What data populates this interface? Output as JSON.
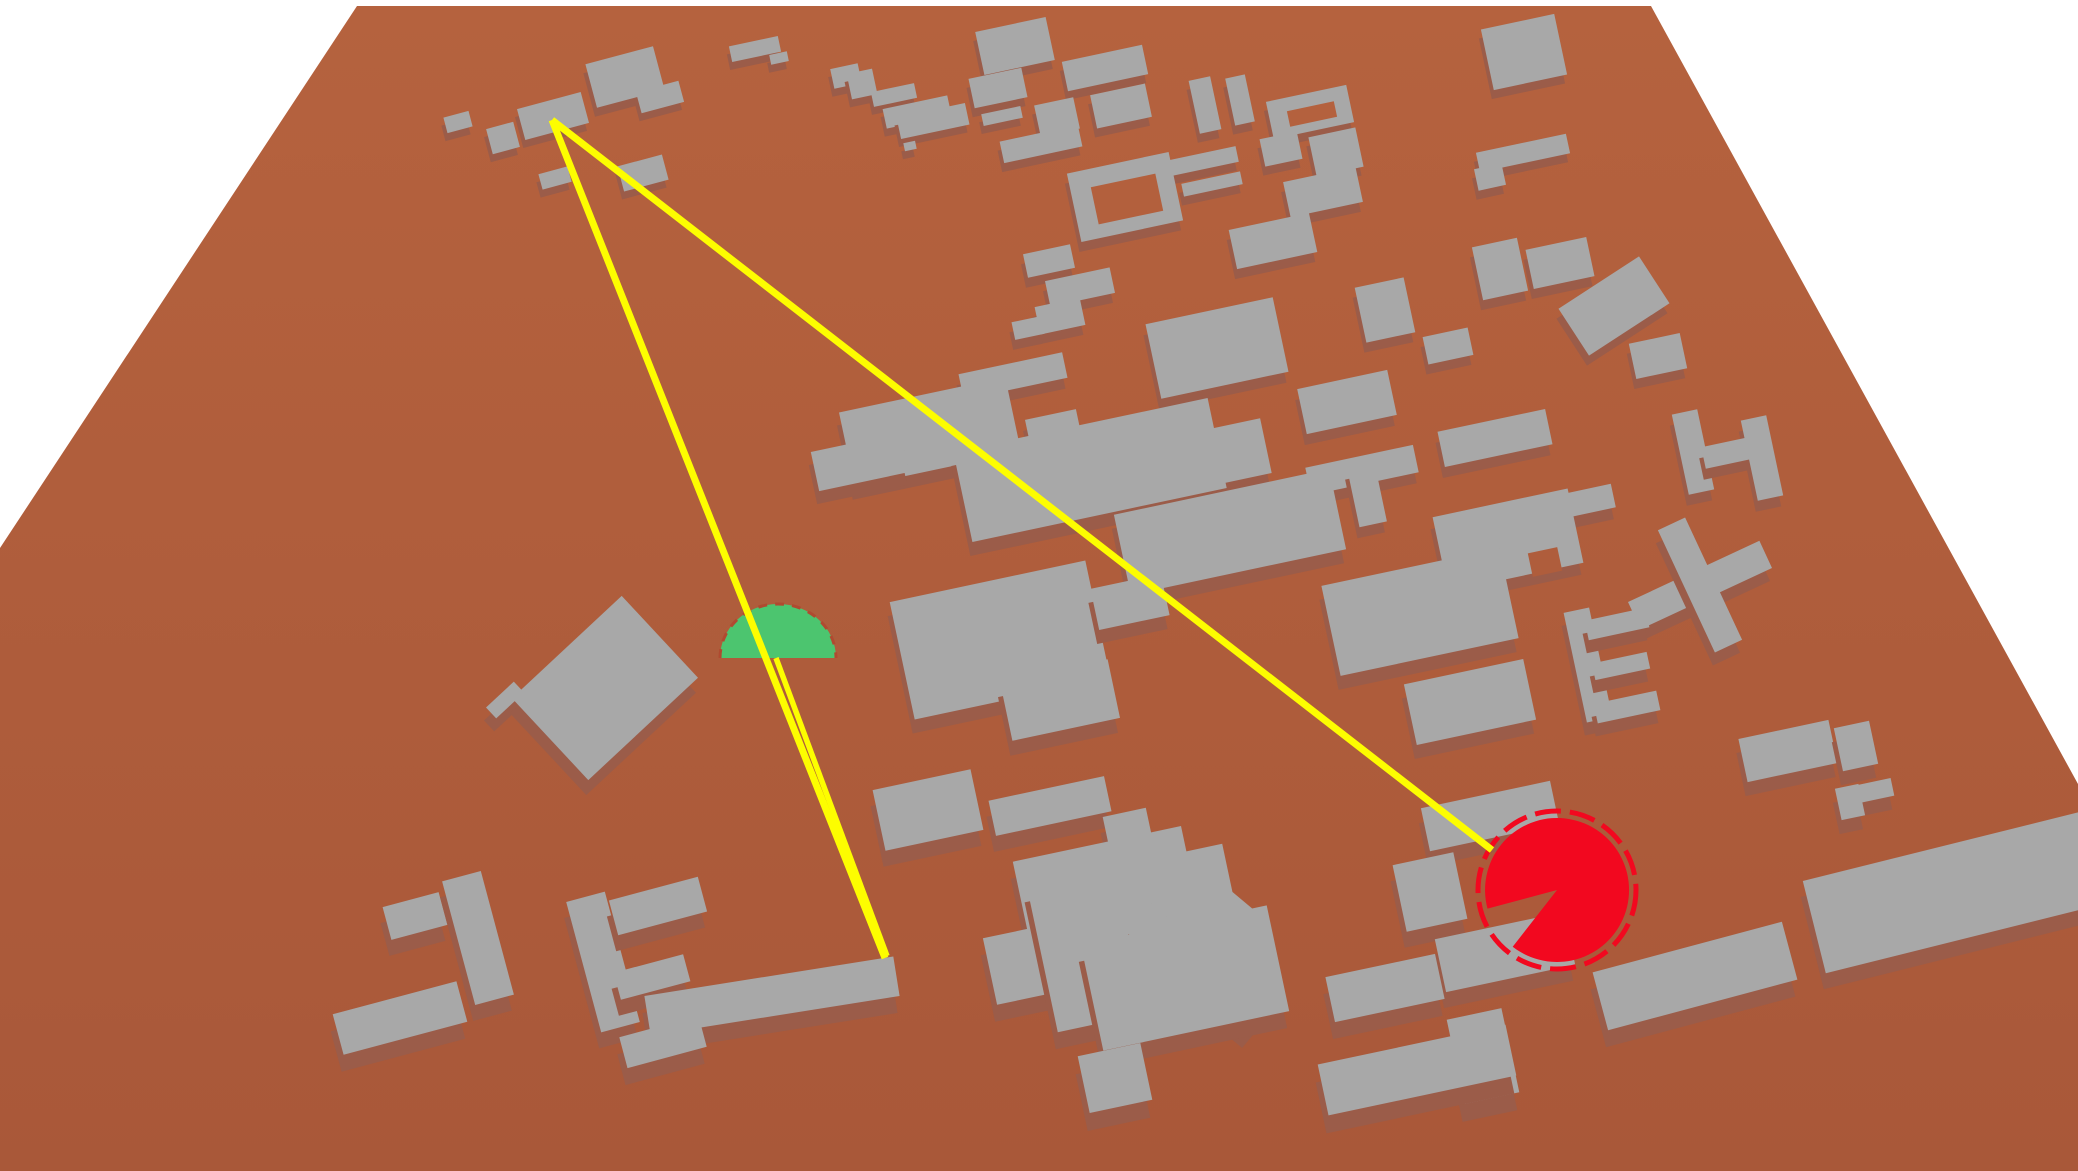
{
  "canvas": {
    "width": 2078,
    "height": 1171,
    "background": "#ffffff"
  },
  "colors": {
    "ground_top": "#b5623e",
    "ground_bottom": "#a95839",
    "roof": "#a8a8a8",
    "side": "#9b5c49",
    "ray": "#fdfd00",
    "tx_green": "#4cc56f",
    "tx_dash": "#b04a30",
    "rx_red": "#f2081f"
  },
  "ground": {
    "pts": "357,6 1651,6 2078,784 2078,1171 0,1171 0,548"
  },
  "buildings": [
    [
      755,
      49,
      50,
      16,
      -12,
      8,
      0
    ],
    [
      779,
      58,
      18,
      10,
      -12,
      8,
      0
    ],
    [
      1015,
      46,
      72,
      44,
      -12,
      9,
      0
    ],
    [
      1524,
      52,
      75,
      62,
      -12,
      9,
      0
    ],
    [
      625,
      77,
      70,
      45,
      -15,
      9,
      0
    ],
    [
      846,
      76,
      28,
      20,
      -12,
      8,
      0
    ],
    [
      862,
      84,
      26,
      26,
      -12,
      8,
      0
    ],
    [
      1105,
      68,
      82,
      30,
      -12,
      9,
      0
    ],
    [
      998,
      88,
      54,
      30,
      -12,
      9,
      0
    ],
    [
      660,
      97,
      44,
      22,
      -15,
      8,
      0
    ],
    [
      894,
      95,
      44,
      15,
      -12,
      8,
      0
    ],
    [
      1205,
      105,
      22,
      54,
      -12,
      9,
      0
    ],
    [
      1240,
      100,
      20,
      48,
      -12,
      9,
      0
    ],
    [
      503,
      138,
      28,
      26,
      -15,
      8,
      0
    ],
    [
      458,
      122,
      26,
      16,
      -15,
      8,
      0
    ],
    [
      553,
      116,
      66,
      32,
      -15,
      8,
      0
    ],
    [
      917,
      112,
      66,
      20,
      -12,
      8,
      0
    ],
    [
      933,
      121,
      70,
      22,
      -12,
      8,
      0
    ],
    [
      1057,
      117,
      40,
      32,
      -12,
      9,
      0
    ],
    [
      1002,
      116,
      40,
      12,
      -12,
      8,
      0
    ],
    [
      1121,
      106,
      56,
      34,
      -12,
      9,
      0
    ],
    [
      1310,
      112,
      82,
      38,
      -12,
      9,
      0
    ],
    [
      1312,
      114,
      48,
      16,
      -12,
      9,
      1
    ],
    [
      1523,
      153,
      92,
      20,
      -12,
      9,
      0
    ],
    [
      910,
      146,
      12,
      8,
      -12,
      8,
      0
    ],
    [
      1041,
      144,
      80,
      22,
      -12,
      9,
      0
    ],
    [
      1336,
      152,
      48,
      40,
      -12,
      9,
      0
    ],
    [
      1281,
      149,
      38,
      28,
      -12,
      9,
      0
    ],
    [
      555,
      178,
      30,
      16,
      -15,
      8,
      0
    ],
    [
      643,
      173,
      46,
      26,
      -15,
      8,
      0
    ],
    [
      1199,
      162,
      78,
      16,
      -12,
      9,
      0
    ],
    [
      1490,
      177,
      28,
      22,
      -12,
      9,
      0
    ],
    [
      1212,
      184,
      60,
      13,
      -12,
      9,
      0
    ],
    [
      1125,
      197,
      104,
      70,
      -12,
      10,
      0
    ],
    [
      1127,
      199,
      66,
      38,
      -12,
      10,
      1
    ],
    [
      1323,
      192,
      74,
      36,
      -12,
      10,
      0
    ],
    [
      1273,
      241,
      82,
      40,
      -12,
      10,
      0
    ],
    [
      1500,
      269,
      46,
      54,
      -12,
      10,
      0
    ],
    [
      1560,
      263,
      62,
      40,
      -12,
      10,
      0
    ],
    [
      1049,
      261,
      48,
      24,
      -12,
      10,
      0
    ],
    [
      1614,
      306,
      96,
      56,
      -33,
      10,
      0
    ],
    [
      1080,
      287,
      66,
      26,
      -12,
      10,
      0
    ],
    [
      1385,
      310,
      50,
      56,
      -12,
      10,
      0
    ],
    [
      1060,
      316,
      46,
      28,
      -12,
      10,
      0
    ],
    [
      1028,
      328,
      30,
      18,
      -12,
      10,
      0
    ],
    [
      1448,
      346,
      46,
      28,
      -12,
      10,
      0
    ],
    [
      1658,
      356,
      52,
      36,
      -12,
      10,
      0
    ],
    [
      1217,
      348,
      130,
      76,
      -12,
      11,
      0
    ],
    [
      1013,
      376,
      106,
      26,
      -12,
      11,
      0
    ],
    [
      1347,
      402,
      92,
      46,
      -12,
      11,
      0
    ],
    [
      1495,
      438,
      110,
      36,
      -12,
      11,
      0
    ],
    [
      1693,
      452,
      26,
      82,
      -12,
      11,
      0
    ],
    [
      1762,
      458,
      26,
      82,
      -12,
      11,
      0
    ],
    [
      1727,
      453,
      48,
      22,
      -12,
      11,
      0
    ],
    [
      930,
      432,
      170,
      76,
      -12,
      13,
      0
    ],
    [
      860,
      462,
      92,
      40,
      -12,
      13,
      0
    ],
    [
      1055,
      436,
      52,
      44,
      -12,
      11,
      0
    ],
    [
      1217,
      456,
      100,
      56,
      -12,
      12,
      0
    ],
    [
      1362,
      470,
      110,
      28,
      -12,
      11,
      0
    ],
    [
      1367,
      495,
      28,
      60,
      -12,
      11,
      0
    ],
    [
      1090,
      470,
      260,
      92,
      -12,
      14,
      0
    ],
    [
      1583,
      502,
      62,
      24,
      -12,
      12,
      0
    ],
    [
      1230,
      532,
      220,
      82,
      -12,
      14,
      0
    ],
    [
      1508,
      540,
      138,
      76,
      -12,
      12,
      0
    ],
    [
      1545,
      562,
      30,
      24,
      -12,
      12,
      1
    ],
    [
      1700,
      585,
      145,
      30,
      -25,
      13,
      0
    ],
    [
      1700,
      585,
      30,
      135,
      -25,
      13,
      0
    ],
    [
      1000,
      640,
      200,
      120,
      -12,
      14,
      0
    ],
    [
      1130,
      602,
      72,
      42,
      -12,
      14,
      0
    ],
    [
      1420,
      612,
      182,
      92,
      -12,
      14,
      0
    ],
    [
      505,
      700,
      38,
      15,
      -43,
      13,
      0
    ],
    [
      605,
      688,
      150,
      112,
      -43,
      15,
      0
    ],
    [
      1588,
      665,
      26,
      112,
      -12,
      13,
      0
    ],
    [
      1617,
      624,
      62,
      20,
      -12,
      13,
      0
    ],
    [
      1621,
      666,
      56,
      17,
      -12,
      13,
      0
    ],
    [
      1627,
      707,
      64,
      20,
      -12,
      13,
      0
    ],
    [
      1470,
      702,
      122,
      62,
      -12,
      14,
      0
    ],
    [
      1060,
      700,
      110,
      60,
      -12,
      15,
      0
    ],
    [
      1788,
      751,
      92,
      44,
      -12,
      14,
      0
    ],
    [
      1856,
      746,
      36,
      44,
      -12,
      14,
      0
    ],
    [
      1868,
      792,
      50,
      18,
      -12,
      14,
      0
    ],
    [
      1850,
      802,
      24,
      32,
      -12,
      14,
      0
    ],
    [
      928,
      810,
      100,
      62,
      -12,
      16,
      0
    ],
    [
      1050,
      806,
      118,
      36,
      -12,
      16,
      0
    ],
    [
      1128,
      830,
      44,
      36,
      -12,
      16,
      0
    ],
    [
      1490,
      816,
      132,
      44,
      -12,
      15,
      0
    ],
    [
      1430,
      892,
      62,
      68,
      -12,
      16,
      0
    ],
    [
      1955,
      892,
      290,
      95,
      -14,
      16,
      0
    ],
    [
      1505,
      952,
      132,
      54,
      -12,
      16,
      0
    ],
    [
      1105,
      882,
      172,
      78,
      -12,
      17,
      0
    ],
    [
      415,
      916,
      58,
      34,
      -15,
      16,
      0
    ],
    [
      478,
      938,
      40,
      128,
      -15,
      16,
      0
    ],
    [
      603,
      962,
      40,
      135,
      -15,
      16,
      0
    ],
    [
      658,
      906,
      92,
      36,
      -15,
      16,
      0
    ],
    [
      1035,
      962,
      92,
      68,
      -12,
      17,
      0
    ],
    [
      1140,
      938,
      200,
      150,
      -12,
      17,
      0
    ],
    [
      1195,
      965,
      160,
      38,
      -50,
      17,
      0
    ],
    [
      1195,
      965,
      38,
      160,
      -50,
      17,
      0
    ],
    [
      652,
      977,
      72,
      28,
      -15,
      16,
      0
    ],
    [
      1385,
      988,
      112,
      46,
      -12,
      17,
      0
    ],
    [
      772,
      996,
      252,
      40,
      -9,
      17,
      0
    ],
    [
      400,
      1018,
      128,
      42,
      -15,
      17,
      0
    ],
    [
      1185,
      978,
      190,
      108,
      -12,
      17,
      0
    ],
    [
      663,
      1042,
      82,
      32,
      -15,
      17,
      0
    ],
    [
      1695,
      976,
      196,
      60,
      -15,
      17,
      0
    ],
    [
      1483,
      1056,
      56,
      86,
      -12,
      18,
      0
    ],
    [
      1417,
      1070,
      192,
      52,
      -12,
      18,
      0
    ],
    [
      1115,
      1078,
      64,
      58,
      -12,
      18,
      0
    ]
  ],
  "tx_marker": {
    "cx": 778,
    "base_y": 658,
    "rx": 58,
    "ry": 54,
    "dash": "9 8",
    "dash_width": 3
  },
  "rx_marker": {
    "cx": 1557,
    "cy": 890,
    "r": 72,
    "ring_r": 79,
    "ring_width": 5,
    "ring_dash": "26 9",
    "mouth_start_deg": 165,
    "mouth_end_deg": 128
  },
  "rays": [
    {
      "x1": 552,
      "y1": 120,
      "x2": 885,
      "y2": 958,
      "w": 7
    },
    {
      "x1": 552,
      "y1": 120,
      "x2": 1492,
      "y2": 850,
      "w": 7
    },
    {
      "x1": 776,
      "y1": 658,
      "x2": 887,
      "y2": 956,
      "w": 5.5
    }
  ]
}
